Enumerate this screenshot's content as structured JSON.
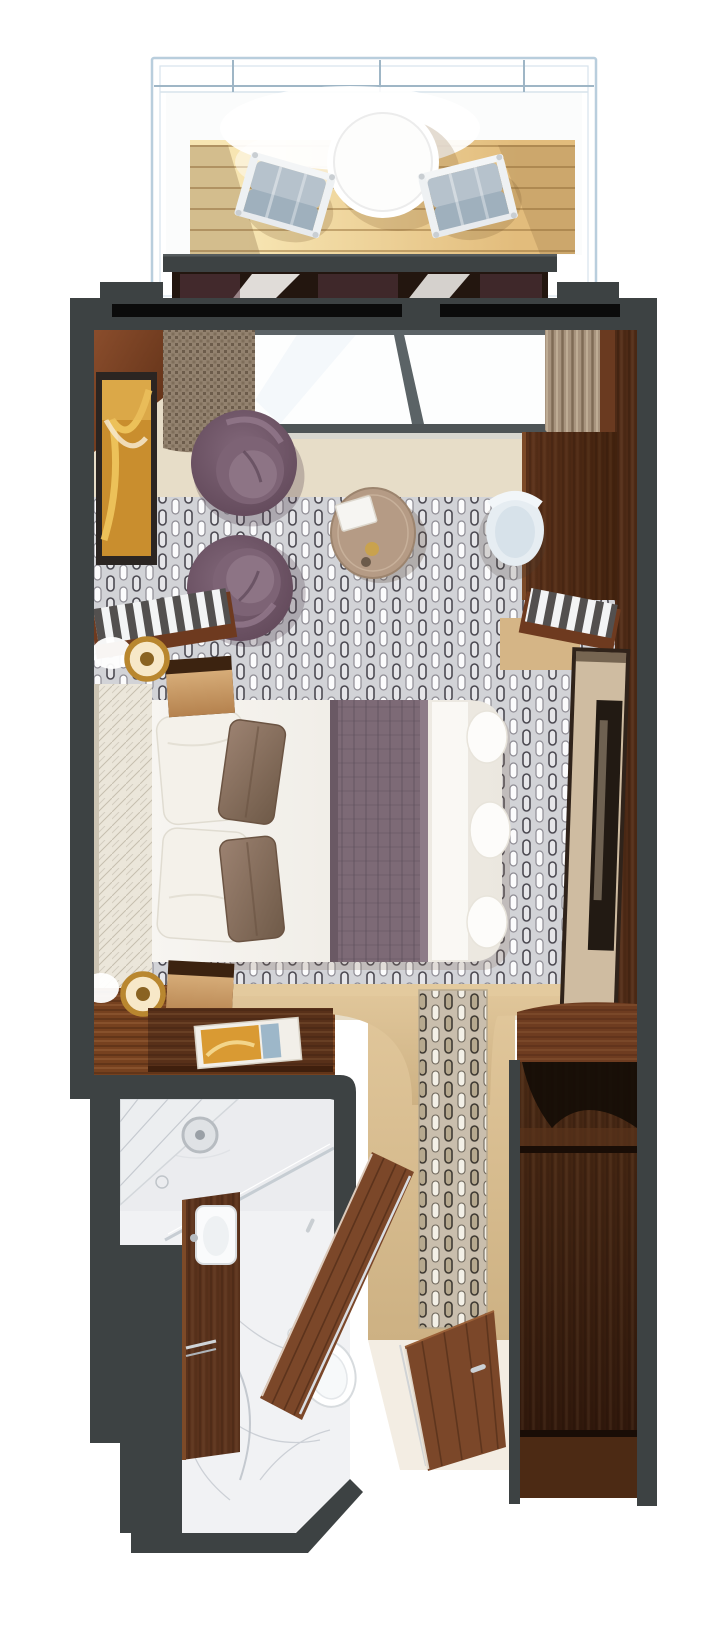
{
  "page": {
    "kind": "stateroom-floorplan-rendering",
    "width_px": 726,
    "height_px": 1630,
    "background": "#ffffff"
  },
  "palette": {
    "wall": "#3d4243",
    "wall_edge": "#565c5e",
    "slot_black": "#0b0b0b",
    "railing": "#b9cedd",
    "rail_line": "#9fb6c6",
    "deck_plank_line": "#a97f44",
    "glass_white": "#fdfefe",
    "mullion": "#5b6366",
    "wood_wall": "#7a4226",
    "wood_jamb": "#4e2a16",
    "cream_floor": "#e7ddc8",
    "tan_floor": "#d8bc8e",
    "plum_chair": "#6a5162",
    "coffee_table": "#b59b85",
    "art_gold": "#d99a33",
    "duvet": "#f5f3ee",
    "bed_runner": "#7d6a76",
    "headboard": "#ebe6da",
    "pillow_white": "#f4f1ea",
    "pillow_accent": "#8d7464",
    "nightstand_front": "#c89e6b",
    "lamp_gold": "#b9872f",
    "desk_wood": "#4f2b16",
    "chair_white": "#e6edf2",
    "mirror_face": "#cfbca1",
    "mirror_glass": "#221a13",
    "closet_wood": "#40220f",
    "entry_wood": "#6e3c20",
    "marble": "#f1f2f4",
    "vanity_wood": "#5a321c",
    "door_wood": "#7b4729",
    "fixture_white": "#ffffff",
    "metal": "#ccd1d5"
  },
  "plan": {
    "balcony": [
      "glass-railing",
      "teak-deck",
      "round-table",
      "deck-chair-left",
      "deck-chair-right"
    ],
    "living_area": [
      "window-wall",
      "curtains",
      "wall-artwork",
      "swivel-chair-upper",
      "swivel-chair-lower",
      "coffee-table",
      "desk",
      "desk-chair",
      "striped-bench-right"
    ],
    "bedroom": [
      "headboard",
      "double-bed",
      "bed-runner",
      "pillows",
      "nightstand-upper",
      "nightstand-lower",
      "table-lamp-upper",
      "table-lamp-lower",
      "striped-console",
      "vanity-desk",
      "art-book",
      "mirror-panel"
    ],
    "corridor": [
      "patterned-runner",
      "tan-floor",
      "entry-door"
    ],
    "closet": [
      "arched-opening",
      "upper-shelf",
      "hanging-space",
      "lower-shelf"
    ],
    "bathroom": [
      "shower",
      "shower-head",
      "glass-screen",
      "vanity-counter",
      "sink",
      "towel-bar",
      "toilet",
      "bathroom-door",
      "marble-floor"
    ]
  }
}
